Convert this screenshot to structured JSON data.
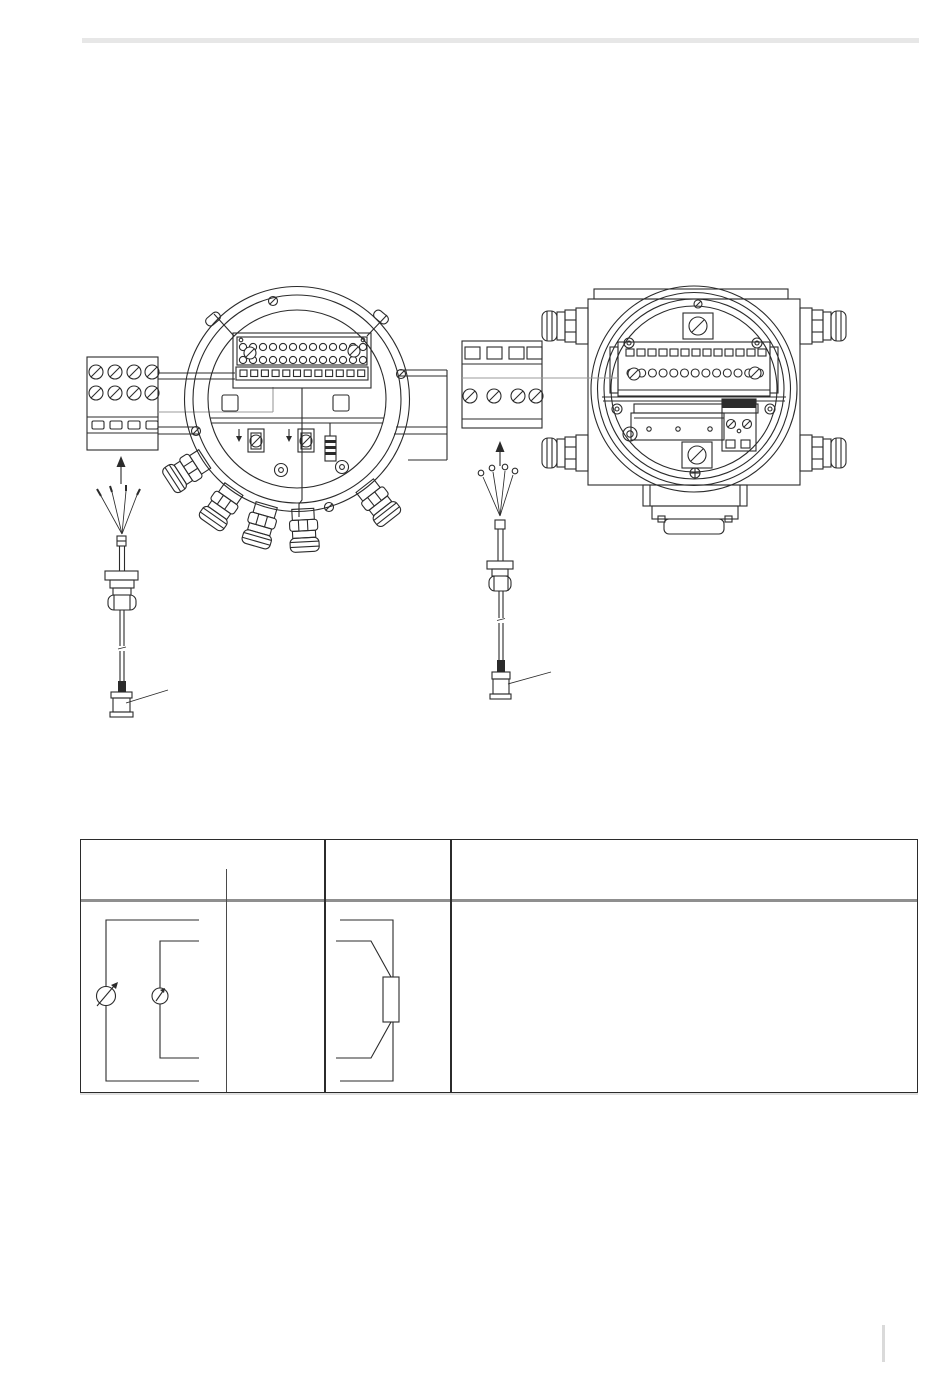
{
  "page": {
    "kind": "technical-manual-page",
    "background": "#ffffff",
    "ink_color": "#2b2b2b",
    "leader_color": "#9b9b9b",
    "rule_color": "#e7e7e7",
    "footer_tick_color": "#dadada",
    "table_header_separator_color": "#8f8f8f"
  },
  "figures": {
    "left_housing": {
      "name": "round-field-housing-connection-compartment",
      "elements": [
        "terminal-strip",
        "terminal-block-detail",
        "cable-glands",
        "sensor-cable",
        "cable-connector",
        "connector-leader-line"
      ]
    },
    "right_housing": {
      "name": "square-field-housing-connection-compartment",
      "elements": [
        "terminal-strip",
        "terminal-block-detail",
        "corner-cable-glands",
        "sensor-cable",
        "cable-connector",
        "connector-leader-line"
      ]
    }
  },
  "table": {
    "columns": [
      {
        "label": ""
      },
      {
        "label": ""
      },
      {
        "label": ""
      }
    ],
    "row": {
      "cell1_symbol": "current-loop-with-adjustable-source-and-meter",
      "cell2_symbol": "four-wire-resistor-connection",
      "cell3_text": ""
    }
  }
}
